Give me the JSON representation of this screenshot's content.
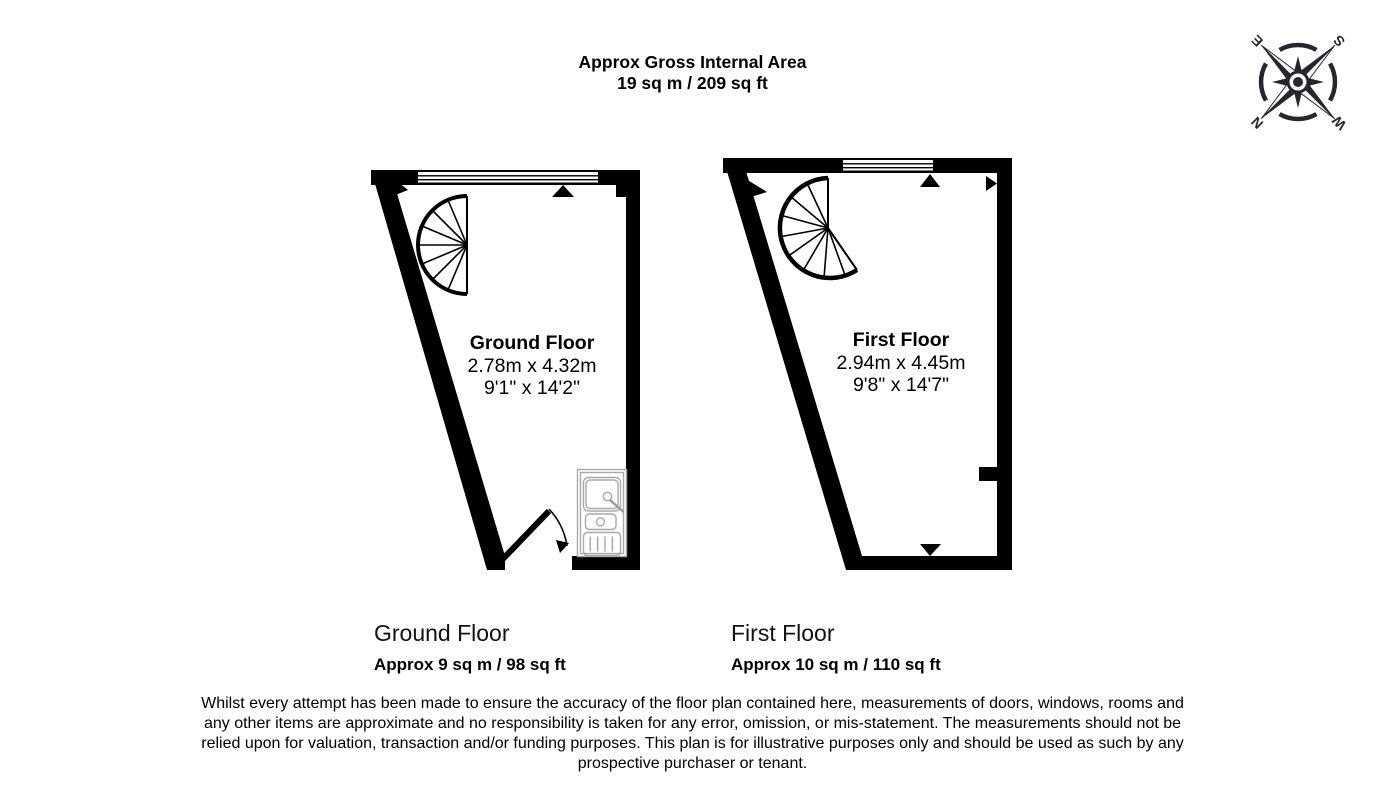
{
  "title": {
    "line1": "Approx Gross Internal Area",
    "line2": "19 sq m / 209 sq ft"
  },
  "compass": {
    "n": "N",
    "e": "E",
    "s": "S",
    "w": "W"
  },
  "ground_floor": {
    "room_label": {
      "name": "Ground Floor",
      "metric": "2.78m x 4.32m",
      "imperial": "9'1\" x 14'2\""
    },
    "caption": {
      "name": "Ground Floor",
      "area": "Approx 9 sq m / 98 sq ft"
    }
  },
  "first_floor": {
    "room_label": {
      "name": "First Floor",
      "metric": "2.94m x 4.45m",
      "imperial": "9'8\" x 14'7\""
    },
    "caption": {
      "name": "First Floor",
      "area": "Approx 10 sq m / 110 sq ft"
    }
  },
  "disclaimer": {
    "lines": [
      "Whilst every attempt has been made to ensure the accuracy of the floor plan contained here, measurements of doors, windows, rooms and",
      "any other items are approximate and no responsibility is taken for any error, omission, or mis-statement. The measurements should not be",
      "relied upon for valuation, transaction and/or funding purposes. This plan is for illustrative purposes only and should be used as such by any",
      "prospective purchaser or tenant."
    ]
  },
  "colors": {
    "wall": "#000000",
    "background": "#ffffff",
    "sink_outline": "#a8a8a8",
    "compass": "#26262e"
  }
}
